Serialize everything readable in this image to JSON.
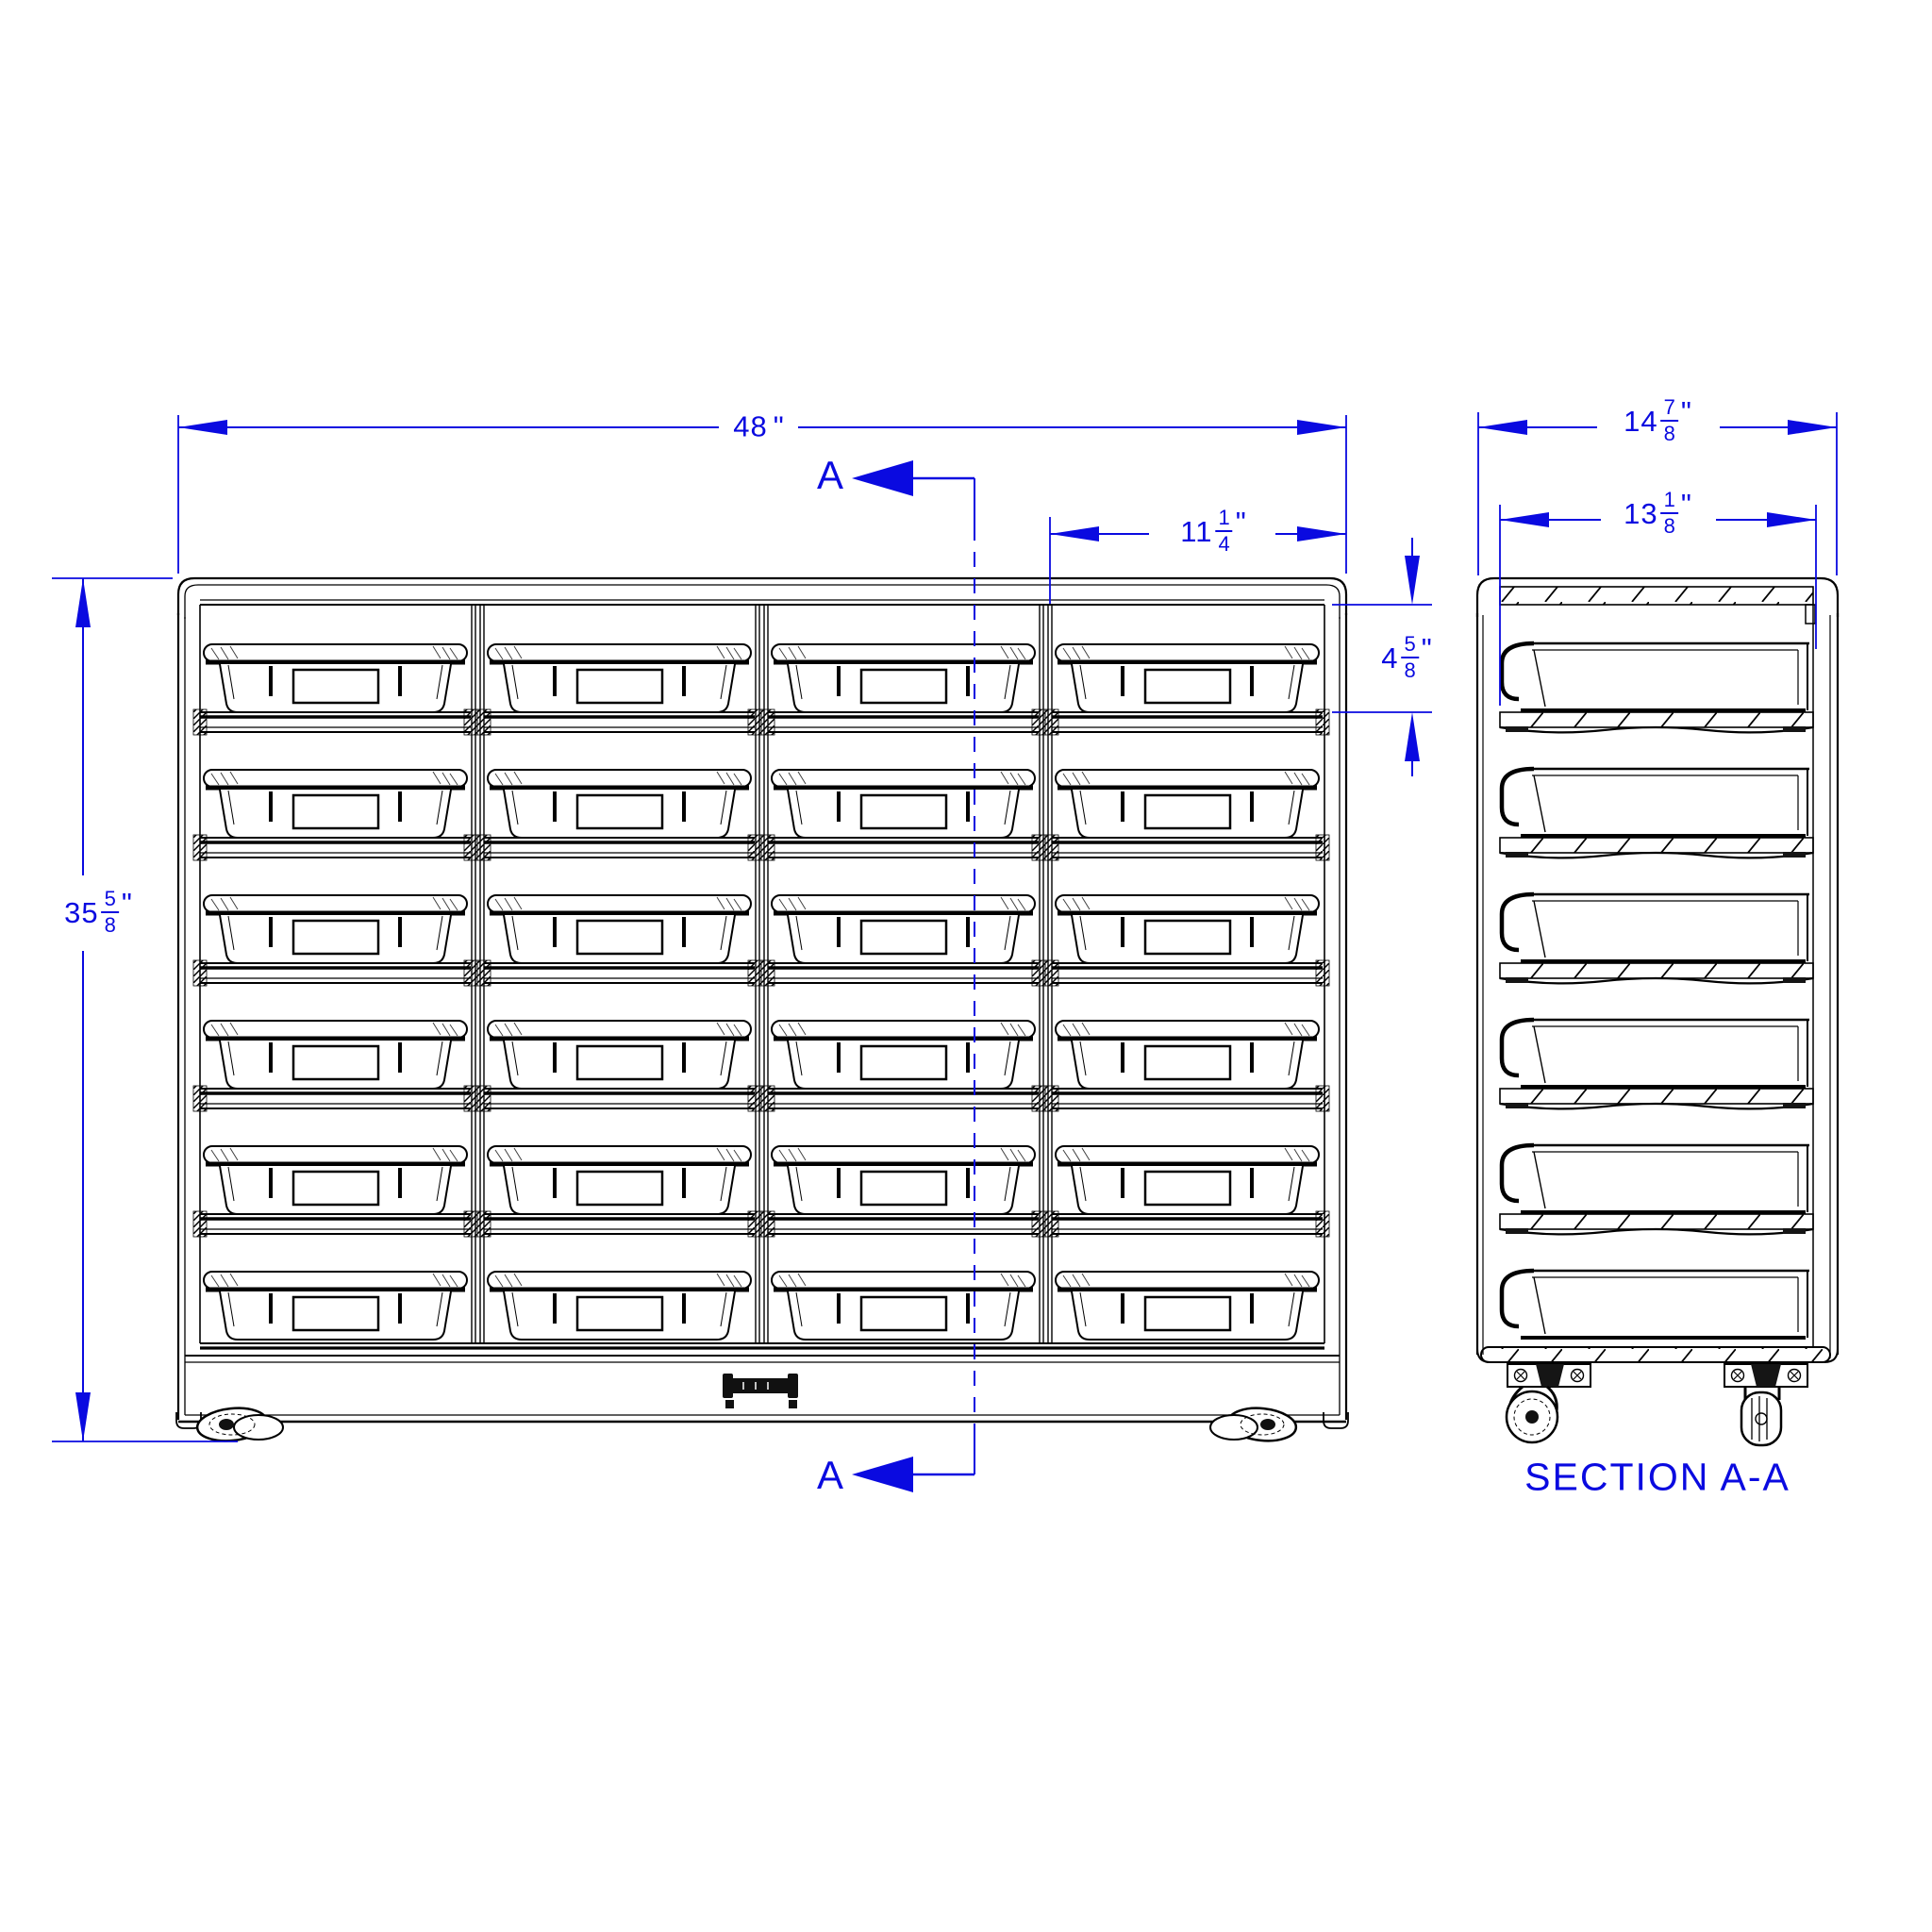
{
  "views": {
    "front": {
      "rows": 6,
      "columns": 4,
      "bin_count": 24,
      "dims": {
        "overall_width": {
          "whole": "48",
          "num": "",
          "den": "",
          "unit": "\""
        },
        "overall_height": {
          "whole": "35",
          "num": "5",
          "den": "8",
          "unit": "\""
        },
        "bin_opening_width": {
          "whole": "11",
          "num": "1",
          "den": "4",
          "unit": "\""
        },
        "bin_opening_height": {
          "whole": "4",
          "num": "5",
          "den": "8",
          "unit": "\""
        }
      },
      "section_cut": {
        "label_top": "A",
        "label_bottom": "A"
      }
    },
    "section": {
      "title": "SECTION A-A",
      "tray_count": 6,
      "dims": {
        "overall_depth": {
          "whole": "14",
          "num": "7",
          "den": "8",
          "unit": "\""
        },
        "tray_depth": {
          "whole": "13",
          "num": "1",
          "den": "8",
          "unit": "\""
        }
      }
    }
  },
  "colors": {
    "dimension_blue": "#0a0ae0",
    "line_black": "#000000",
    "background": "#ffffff"
  }
}
